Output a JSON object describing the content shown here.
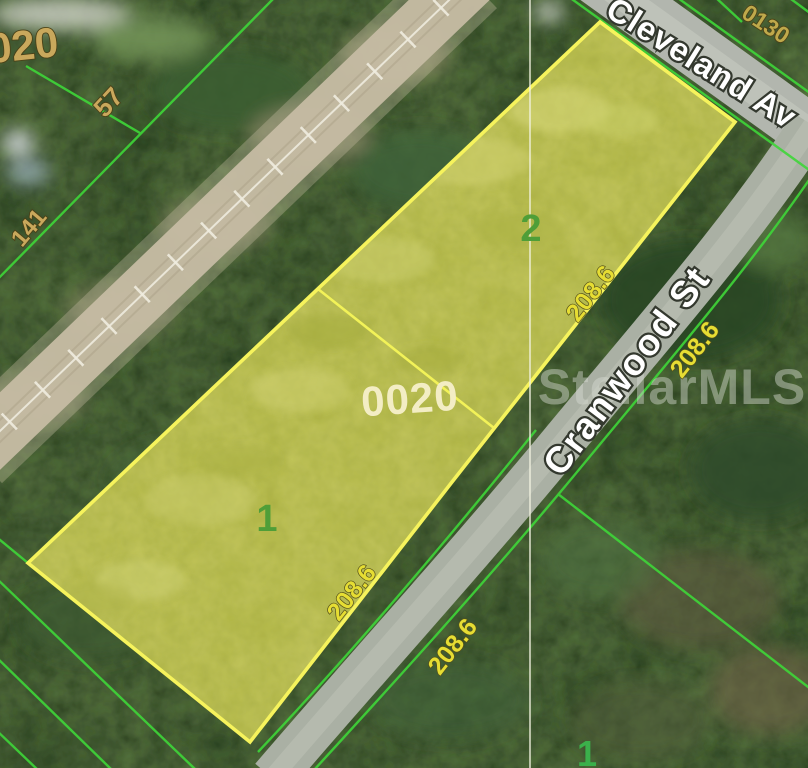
{
  "map": {
    "watermark": "StellarMLS",
    "streets": {
      "cleveland": "Cleveland Av",
      "cranwood": "Cranwood St"
    },
    "blocks": {
      "main": "0020",
      "top_left_partial": "020",
      "top_right": "0130"
    },
    "lots": {
      "upper": "2",
      "lower": "1",
      "adjacent_south": "1"
    },
    "dimensions": {
      "upper_edge_inner": "208.6",
      "upper_edge_outer": "208.6",
      "lower_edge_inner": "208.6",
      "lower_edge_outer": "208.6",
      "northwest_57": "57",
      "west_141": "141"
    },
    "colors": {
      "dimension_yellow": "#e6dd33",
      "block_gold": "#c9a85c",
      "block_gold_small": "#bfa94b",
      "block_cream": "#f3edc4",
      "lot_green": "#4f9e38",
      "adjacent_lot_green": "#3bb04b",
      "street_label_white": "#ffffff",
      "watermark_gray": "#d8dcd2",
      "parcel_border_yellow": "#f6f35c",
      "cadastral_line_green": "#3fd639"
    }
  }
}
